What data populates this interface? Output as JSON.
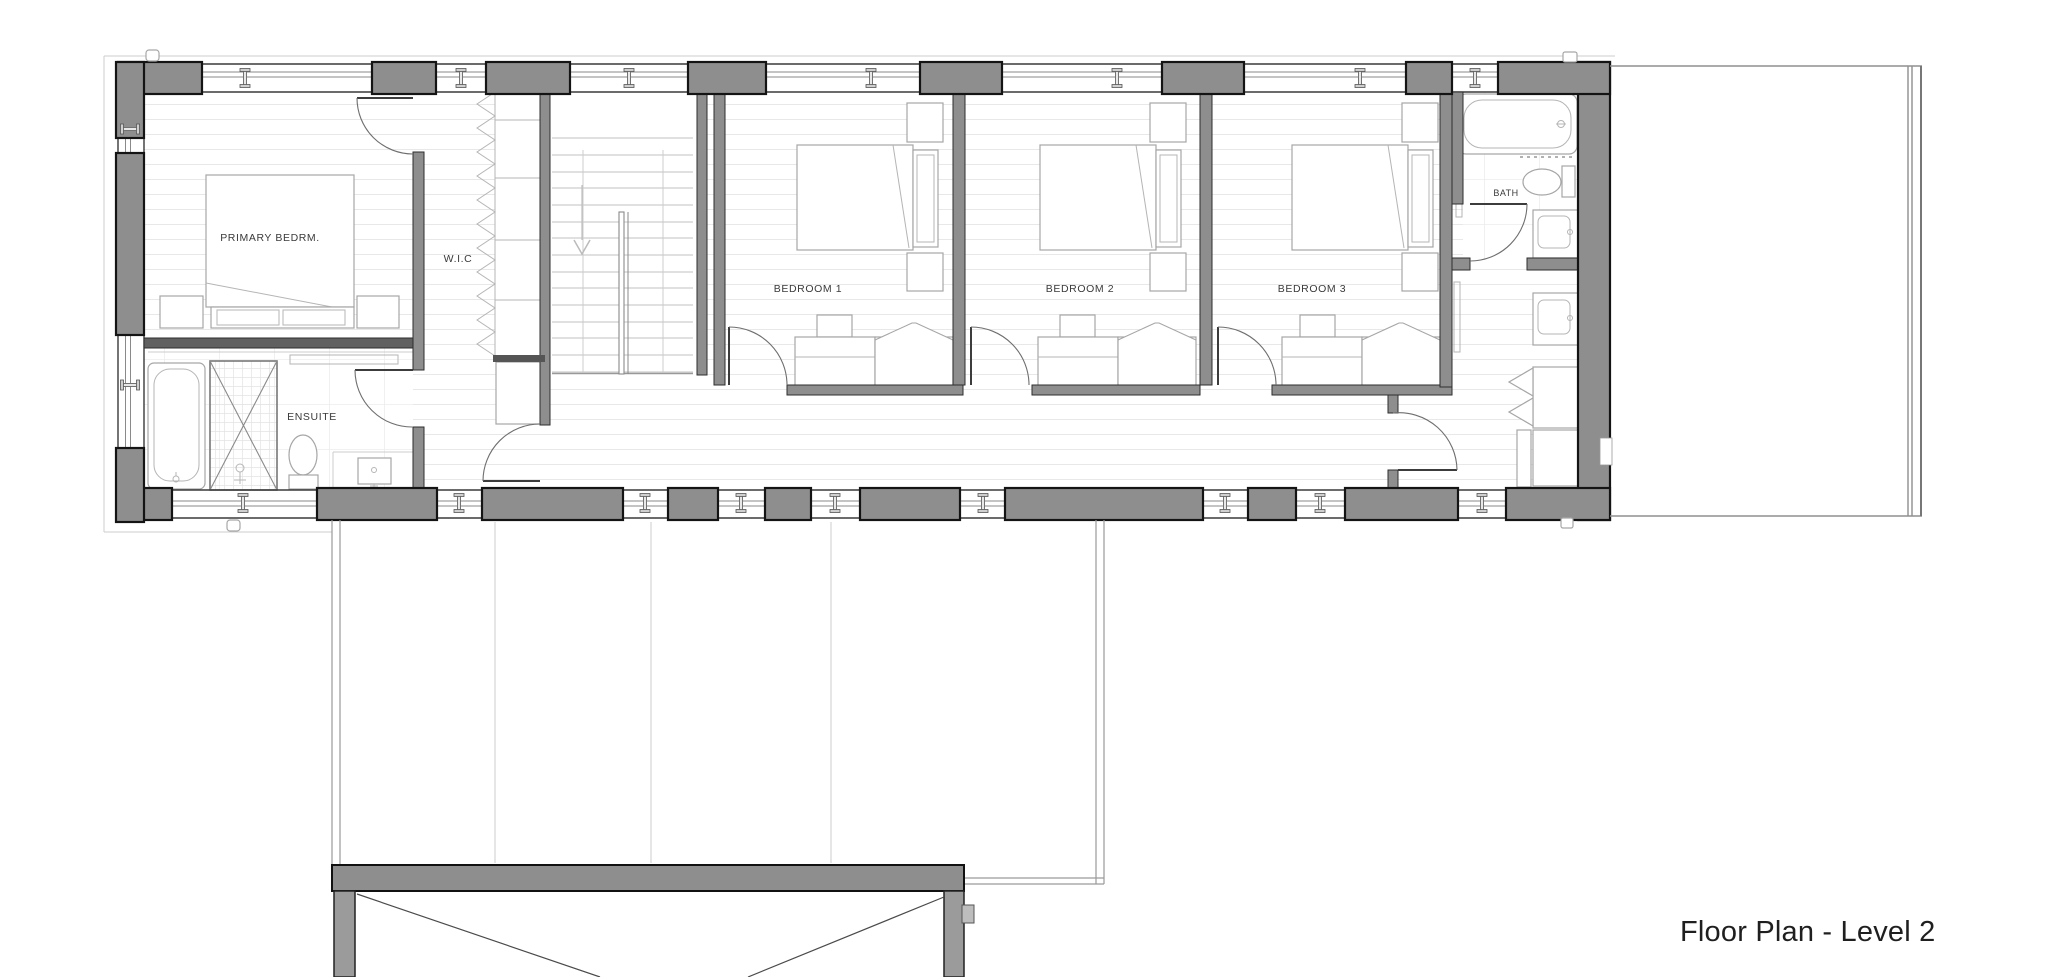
{
  "plan": {
    "title": "Floor Plan - Level 2",
    "rooms": [
      {
        "id": "primary-bedroom",
        "label": "PRIMARY BEDRM."
      },
      {
        "id": "walk-in-closet",
        "label": "W.I.C"
      },
      {
        "id": "ensuite",
        "label": "ENSUITE"
      },
      {
        "id": "bedroom-1",
        "label": "BEDROOM 1"
      },
      {
        "id": "bedroom-2",
        "label": "BEDROOM 2"
      },
      {
        "id": "bedroom-3",
        "label": "BEDROOM 3"
      },
      {
        "id": "bath",
        "label": "BATH"
      }
    ],
    "colors": {
      "wall_gray": "#8e8e8e",
      "wall_dark": "#606060",
      "floor_hatch": "#e8e8e8",
      "label_text": "#3a3a3a",
      "title_text": "#1f1f1f"
    }
  }
}
